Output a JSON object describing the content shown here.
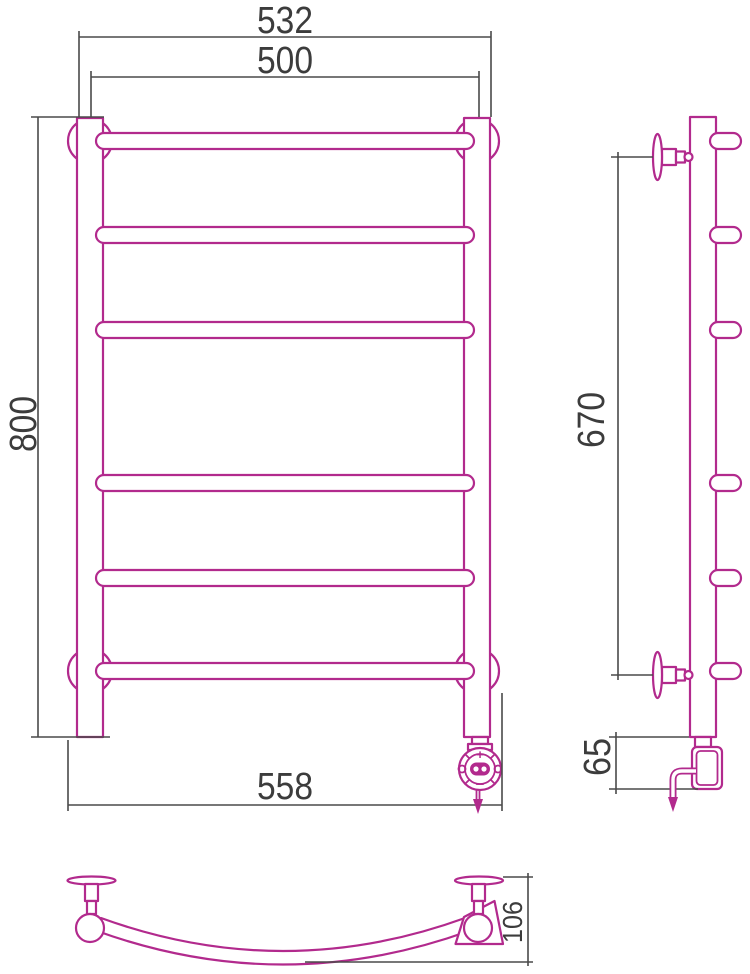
{
  "colors": {
    "outline": "#b22a8d",
    "dimension": "#4a4a4a",
    "label": "#3c3c3c",
    "background": "#ffffff"
  },
  "dimensions": {
    "front_overall_width": "532",
    "front_rail_width": "500",
    "front_height": "800",
    "front_bottom_width": "558",
    "side_bracket_span": "670",
    "side_heater_offset": "65",
    "plan_depth": "106"
  },
  "regulator": {
    "plus_label": "+",
    "minus_label": "−"
  }
}
